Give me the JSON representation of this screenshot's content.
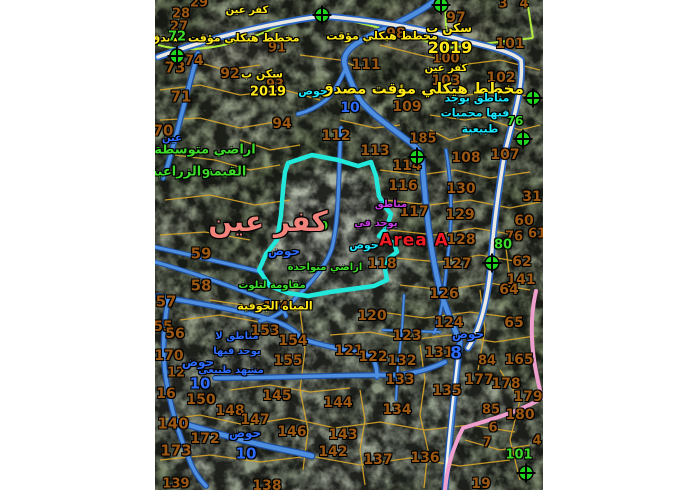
{
  "map": {
    "region_name": "كفر عين",
    "zone_tag": "Area A",
    "plan_note": "مخطط هيكلي مؤقت مصدق",
    "plan_year": "2019"
  },
  "colors": {
    "parcel": "#9c5812",
    "yellow": "#ffe81a",
    "green": "#3ddc2a",
    "cyan": "#19e8ff",
    "blue": "#2e6bff",
    "purple": "#c43ae0",
    "red": "#ed1c24",
    "pink": "#f2837b",
    "road_blue": "#4f8fe0",
    "road_casing": "#1f4f9e",
    "road_pink": "#ef9fce",
    "parcel_line": "#d9a62a",
    "boundary_chartreuse": "#b6f53c",
    "highlight_cyan": "#22e8dc",
    "marker_green": "#1fd51f"
  },
  "labels": [
    {
      "t": "كفر عين",
      "x": 247,
      "y": 11,
      "c": "yellow",
      "s": 10,
      "n": "village-name-small"
    },
    {
      "t": "مخطط هيكلي مؤقت مصدق",
      "x": 225,
      "y": 38,
      "c": "yellow",
      "s": 11,
      "n": "plan-status-label"
    },
    {
      "t": "مخطط هيكلي مؤقت",
      "x": 382,
      "y": 36,
      "c": "yellow",
      "s": 11,
      "n": "plan-status-label"
    },
    {
      "t": "سكن ب",
      "x": 262,
      "y": 74,
      "c": "yellow",
      "s": 11,
      "n": "zoning-label"
    },
    {
      "t": "2019",
      "x": 268,
      "y": 92,
      "c": "yellow",
      "s": 13,
      "n": "plan-year-label"
    },
    {
      "t": "سكن ب",
      "x": 449,
      "y": 28,
      "c": "yellow",
      "s": 12,
      "n": "zoning-label"
    },
    {
      "t": "2019",
      "x": 450,
      "y": 48,
      "c": "yellow",
      "s": 16,
      "n": "plan-year-label"
    },
    {
      "t": "كفر عين",
      "x": 446,
      "y": 69,
      "c": "yellow",
      "s": 10,
      "n": "village-name-small"
    },
    {
      "t": "مخطط هيكلي مؤقت مصدق",
      "x": 422,
      "y": 89,
      "c": "yellow",
      "s": 15,
      "n": "plan-status-label"
    },
    {
      "t": "المياه الجوفية",
      "x": 275,
      "y": 306,
      "c": "yellow",
      "s": 11,
      "n": "groundwater-label"
    },
    {
      "t": "72",
      "x": 177,
      "y": 37,
      "c": "green",
      "s": 13
    },
    {
      "t": "اراضي متوسطة",
      "x": 205,
      "y": 150,
      "c": "green",
      "s": 13,
      "n": "agri-value-label"
    },
    {
      "t": "القيمة الزراعية",
      "x": 198,
      "y": 172,
      "c": "green",
      "s": 13,
      "n": "agri-value-label"
    },
    {
      "t": "9",
      "x": 206,
      "y": 174,
      "c": "green",
      "s": 12
    },
    {
      "t": "9",
      "x": 324,
      "y": 226,
      "c": "green",
      "s": 12
    },
    {
      "t": "اراضي متواجدة",
      "x": 325,
      "y": 268,
      "c": "green",
      "s": 10,
      "n": "land-note-label"
    },
    {
      "t": "مقاومة لتلوث",
      "x": 272,
      "y": 286,
      "c": "green",
      "s": 10,
      "n": "land-note-label"
    },
    {
      "t": "76",
      "x": 515,
      "y": 121,
      "c": "green",
      "s": 12
    },
    {
      "t": "80",
      "x": 503,
      "y": 245,
      "c": "green",
      "s": 13
    },
    {
      "t": "101",
      "x": 519,
      "y": 455,
      "c": "green",
      "s": 13
    },
    {
      "t": "مناطق يوجد",
      "x": 477,
      "y": 98,
      "c": "cyan",
      "s": 11,
      "n": "nature-reserve-label"
    },
    {
      "t": "فيها محميات",
      "x": 475,
      "y": 113,
      "c": "cyan",
      "s": 11,
      "n": "nature-reserve-label"
    },
    {
      "t": "طبيعية",
      "x": 480,
      "y": 129,
      "c": "cyan",
      "s": 11,
      "n": "nature-reserve-label"
    },
    {
      "t": "حوض",
      "x": 313,
      "y": 91,
      "c": "cyan",
      "s": 11,
      "n": "basin-label"
    },
    {
      "t": "حوض",
      "x": 364,
      "y": 245,
      "c": "cyan",
      "s": 11,
      "n": "basin-label"
    },
    {
      "t": "عين",
      "x": 172,
      "y": 139,
      "c": "blue",
      "s": 10
    },
    {
      "t": "حوض",
      "x": 284,
      "y": 251,
      "c": "blue",
      "s": 12,
      "n": "basin-label"
    },
    {
      "t": "حوض",
      "x": 468,
      "y": 334,
      "c": "blue",
      "s": 12,
      "n": "basin-label"
    },
    {
      "t": "8",
      "x": 456,
      "y": 354,
      "c": "blue",
      "s": 17,
      "n": "basin-number"
    },
    {
      "t": "10",
      "x": 350,
      "y": 108,
      "c": "blue",
      "s": 14,
      "n": "basin-number"
    },
    {
      "t": "مناطق لا",
      "x": 237,
      "y": 337,
      "c": "blue",
      "s": 10,
      "n": "landscape-note-label"
    },
    {
      "t": "يوجد فيها",
      "x": 237,
      "y": 352,
      "c": "blue",
      "s": 10,
      "n": "landscape-note-label"
    },
    {
      "t": "مشهد طبيعي",
      "x": 231,
      "y": 371,
      "c": "blue",
      "s": 10,
      "n": "landscape-note-label"
    },
    {
      "t": "حوض",
      "x": 198,
      "y": 362,
      "c": "blue",
      "s": 12,
      "n": "basin-label"
    },
    {
      "t": "10",
      "x": 200,
      "y": 384,
      "c": "blue",
      "s": 15,
      "n": "basin-number"
    },
    {
      "t": "حوض",
      "x": 245,
      "y": 433,
      "c": "blue",
      "s": 12,
      "n": "basin-label"
    },
    {
      "t": "10",
      "x": 246,
      "y": 454,
      "c": "blue",
      "s": 15,
      "n": "basin-number"
    },
    {
      "t": "مناطق",
      "x": 391,
      "y": 205,
      "c": "purple",
      "s": 10,
      "n": "zone-note-label"
    },
    {
      "t": "يوجد في",
      "x": 376,
      "y": 224,
      "c": "purple",
      "s": 10,
      "n": "zone-note-label"
    },
    {
      "t": "Area A",
      "x": 414,
      "y": 241,
      "c": "red",
      "s": 17,
      "ls": 1,
      "n": "area-a-label"
    },
    {
      "t": "كفر عين",
      "x": 268,
      "y": 222,
      "c": "pink",
      "s": 28,
      "n": "village-name-label"
    }
  ],
  "parcel_numbers": [
    {
      "t": "29",
      "x": 199,
      "y": 3
    },
    {
      "t": "28",
      "x": 181,
      "y": 14
    },
    {
      "t": "27",
      "x": 179,
      "y": 27
    },
    {
      "t": "73",
      "x": 175,
      "y": 68,
      "s": 15
    },
    {
      "t": "74",
      "x": 194,
      "y": 61,
      "s": 14
    },
    {
      "t": "71",
      "x": 181,
      "y": 97,
      "s": 15
    },
    {
      "t": "70",
      "x": 163,
      "y": 131,
      "s": 15
    },
    {
      "t": "91",
      "x": 277,
      "y": 48
    },
    {
      "t": "92",
      "x": 230,
      "y": 74,
      "s": 14
    },
    {
      "t": "93",
      "x": 275,
      "y": 85
    },
    {
      "t": "94",
      "x": 282,
      "y": 124,
      "s": 14
    },
    {
      "t": "97",
      "x": 456,
      "y": 18,
      "s": 14
    },
    {
      "t": "98",
      "x": 396,
      "y": 34,
      "s": 14
    },
    {
      "t": "100",
      "x": 446,
      "y": 59
    },
    {
      "t": "101",
      "x": 510,
      "y": 44,
      "s": 14
    },
    {
      "t": "102",
      "x": 501,
      "y": 78,
      "s": 14
    },
    {
      "t": "103",
      "x": 446,
      "y": 81,
      "s": 14
    },
    {
      "t": "3",
      "x": 503,
      "y": 4
    },
    {
      "t": "4",
      "x": 524,
      "y": 4
    },
    {
      "t": "111",
      "x": 366,
      "y": 65,
      "s": 14
    },
    {
      "t": "109",
      "x": 407,
      "y": 107,
      "s": 14
    },
    {
      "t": "185",
      "x": 423,
      "y": 139
    },
    {
      "t": "112",
      "x": 336,
      "y": 136,
      "s": 14
    },
    {
      "t": "113",
      "x": 375,
      "y": 151,
      "s": 14
    },
    {
      "t": "114",
      "x": 407,
      "y": 166,
      "s": 14
    },
    {
      "t": "108",
      "x": 466,
      "y": 158,
      "s": 14
    },
    {
      "t": "107",
      "x": 505,
      "y": 155,
      "s": 14
    },
    {
      "t": "116",
      "x": 403,
      "y": 186,
      "s": 14
    },
    {
      "t": "117",
      "x": 414,
      "y": 212,
      "s": 14
    },
    {
      "t": "130",
      "x": 461,
      "y": 189,
      "s": 14
    },
    {
      "t": "129",
      "x": 460,
      "y": 215,
      "s": 14
    },
    {
      "t": "31",
      "x": 532,
      "y": 197,
      "s": 14
    },
    {
      "t": "60",
      "x": 524,
      "y": 221,
      "s": 14
    },
    {
      "t": "76",
      "x": 514,
      "y": 237
    },
    {
      "t": "61",
      "x": 537,
      "y": 234
    },
    {
      "t": "128",
      "x": 461,
      "y": 240,
      "s": 14
    },
    {
      "t": "62",
      "x": 522,
      "y": 262,
      "s": 14
    },
    {
      "t": "118",
      "x": 382,
      "y": 264,
      "s": 14
    },
    {
      "t": "127",
      "x": 457,
      "y": 264,
      "s": 14
    },
    {
      "t": "141",
      "x": 521,
      "y": 280,
      "s": 14
    },
    {
      "t": "126",
      "x": 444,
      "y": 294,
      "s": 14
    },
    {
      "t": "64",
      "x": 509,
      "y": 290,
      "s": 14
    },
    {
      "t": "59",
      "x": 201,
      "y": 254,
      "s": 15
    },
    {
      "t": "58",
      "x": 201,
      "y": 286,
      "s": 15
    },
    {
      "t": "57",
      "x": 166,
      "y": 302,
      "s": 15
    },
    {
      "t": "174",
      "x": 276,
      "y": 306,
      "s": 12
    },
    {
      "t": "120",
      "x": 372,
      "y": 316,
      "s": 14
    },
    {
      "t": "124",
      "x": 449,
      "y": 323,
      "s": 14
    },
    {
      "t": "65",
      "x": 514,
      "y": 323,
      "s": 14
    },
    {
      "t": "55",
      "x": 163,
      "y": 327,
      "s": 14
    },
    {
      "t": "56",
      "x": 175,
      "y": 334,
      "s": 14
    },
    {
      "t": "153",
      "x": 265,
      "y": 331,
      "s": 14
    },
    {
      "t": "154",
      "x": 293,
      "y": 341,
      "s": 14
    },
    {
      "t": "121",
      "x": 349,
      "y": 351,
      "s": 14
    },
    {
      "t": "122",
      "x": 373,
      "y": 357,
      "s": 14
    },
    {
      "t": "123",
      "x": 407,
      "y": 336,
      "s": 14
    },
    {
      "t": "170",
      "x": 169,
      "y": 356,
      "s": 14
    },
    {
      "t": "155",
      "x": 288,
      "y": 361,
      "s": 14
    },
    {
      "t": "12",
      "x": 176,
      "y": 373
    },
    {
      "t": "131",
      "x": 439,
      "y": 353,
      "s": 14
    },
    {
      "t": "84",
      "x": 487,
      "y": 361
    },
    {
      "t": "165",
      "x": 519,
      "y": 360,
      "s": 14
    },
    {
      "t": "132",
      "x": 402,
      "y": 361,
      "s": 14
    },
    {
      "t": "133",
      "x": 400,
      "y": 380,
      "s": 14
    },
    {
      "t": "135",
      "x": 447,
      "y": 391,
      "s": 14
    },
    {
      "t": "177",
      "x": 479,
      "y": 380,
      "s": 14
    },
    {
      "t": "178",
      "x": 506,
      "y": 384,
      "s": 14
    },
    {
      "t": "179",
      "x": 528,
      "y": 397,
      "s": 14
    },
    {
      "t": "16",
      "x": 166,
      "y": 394,
      "s": 14
    },
    {
      "t": "150",
      "x": 201,
      "y": 400,
      "s": 14
    },
    {
      "t": "145",
      "x": 277,
      "y": 396,
      "s": 14
    },
    {
      "t": "144",
      "x": 338,
      "y": 403,
      "s": 14
    },
    {
      "t": "148",
      "x": 230,
      "y": 411,
      "s": 14
    },
    {
      "t": "134",
      "x": 397,
      "y": 410,
      "s": 14
    },
    {
      "t": "85",
      "x": 491,
      "y": 410
    },
    {
      "t": "180",
      "x": 520,
      "y": 415,
      "s": 14
    },
    {
      "t": "140",
      "x": 173,
      "y": 424,
      "s": 15
    },
    {
      "t": "147",
      "x": 255,
      "y": 420,
      "s": 14
    },
    {
      "t": "6",
      "x": 493,
      "y": 428
    },
    {
      "t": "146",
      "x": 292,
      "y": 432,
      "s": 14
    },
    {
      "t": "143",
      "x": 343,
      "y": 435,
      "s": 14
    },
    {
      "t": "172",
      "x": 205,
      "y": 439,
      "s": 14
    },
    {
      "t": "7",
      "x": 487,
      "y": 443
    },
    {
      "t": "4",
      "x": 537,
      "y": 441
    },
    {
      "t": "173",
      "x": 176,
      "y": 451,
      "s": 15
    },
    {
      "t": "142",
      "x": 333,
      "y": 452,
      "s": 14
    },
    {
      "t": "137",
      "x": 378,
      "y": 460,
      "s": 14
    },
    {
      "t": "136",
      "x": 425,
      "y": 458,
      "s": 14
    },
    {
      "t": "19",
      "x": 481,
      "y": 484,
      "s": 14
    },
    {
      "t": "138",
      "x": 267,
      "y": 486,
      "s": 14
    },
    {
      "t": "139",
      "x": 176,
      "y": 484
    }
  ],
  "markers": [
    {
      "x": 177,
      "y": 56
    },
    {
      "x": 322,
      "y": 15
    },
    {
      "x": 441,
      "y": 5
    },
    {
      "x": 417,
      "y": 157
    },
    {
      "x": 533,
      "y": 98
    },
    {
      "x": 523,
      "y": 139
    },
    {
      "x": 492,
      "y": 263
    },
    {
      "x": 526,
      "y": 473
    }
  ]
}
